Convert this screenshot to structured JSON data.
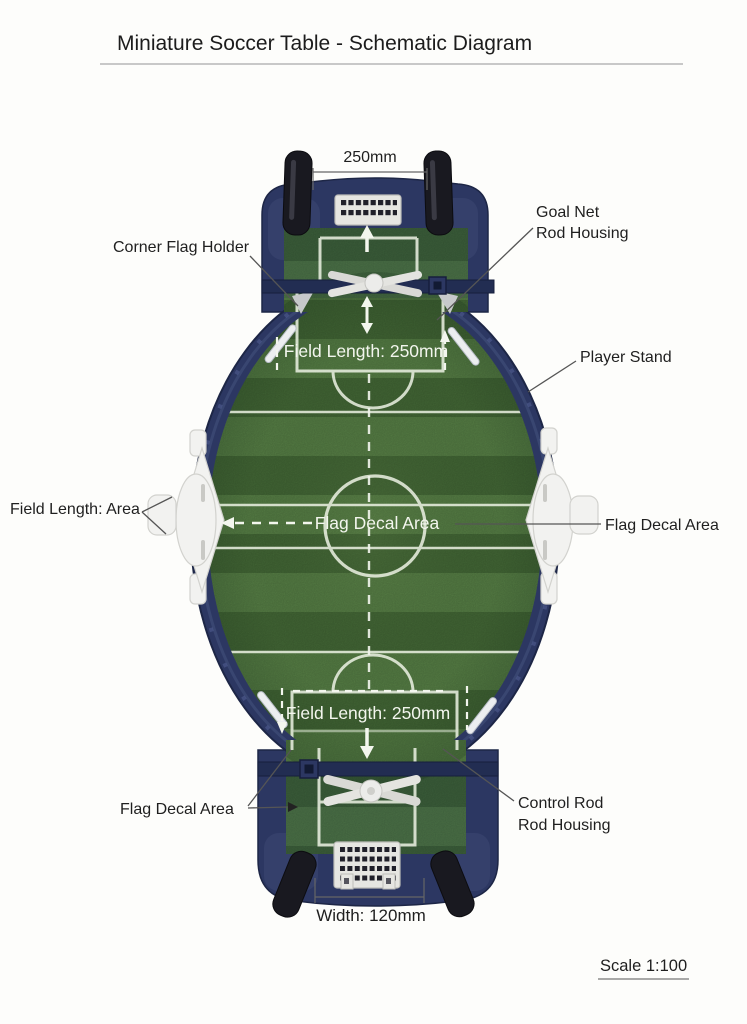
{
  "title": "Miniature Soccer Table - Schematic Diagram",
  "dimensions": {
    "top_width": "250mm",
    "bottom_width": "Width: 120mm",
    "scale": "Scale 1:100"
  },
  "field_annotations": {
    "field_length_top": "Field Length: 250mm",
    "flag_decal_center": "Flag Decal Area",
    "field_length_bottom": "Field Length: 250mm"
  },
  "callouts": {
    "goal_net_housing": {
      "line1": "Goal Net",
      "line2": "Rod Housing"
    },
    "corner_flag_holder": "Corner Flag Holder",
    "player_stand": "Player Stand",
    "field_length_area": "Field Length: Area",
    "flag_decal_right": "Flag Decal Area",
    "flag_decal_bottom_left": "Flag Decal Area",
    "control_rod_housing": {
      "line1": "Control Rod",
      "line2": "Rod Housing"
    }
  },
  "colors": {
    "frame_navy": "#2c3762",
    "frame_navy_dark": "#1d2646",
    "frame_navy_light": "#46537e",
    "grass_dark": "#466c38",
    "grass_light": "#5a8448",
    "field_line_white": "#edf2e4",
    "goal_white": "#e6e6e2",
    "goal_hole_dark": "#20202a",
    "rod_black": "#191920",
    "handle_white": "#f2f2f0",
    "leader_gray": "#555555",
    "text_black": "#1f1f1f"
  }
}
